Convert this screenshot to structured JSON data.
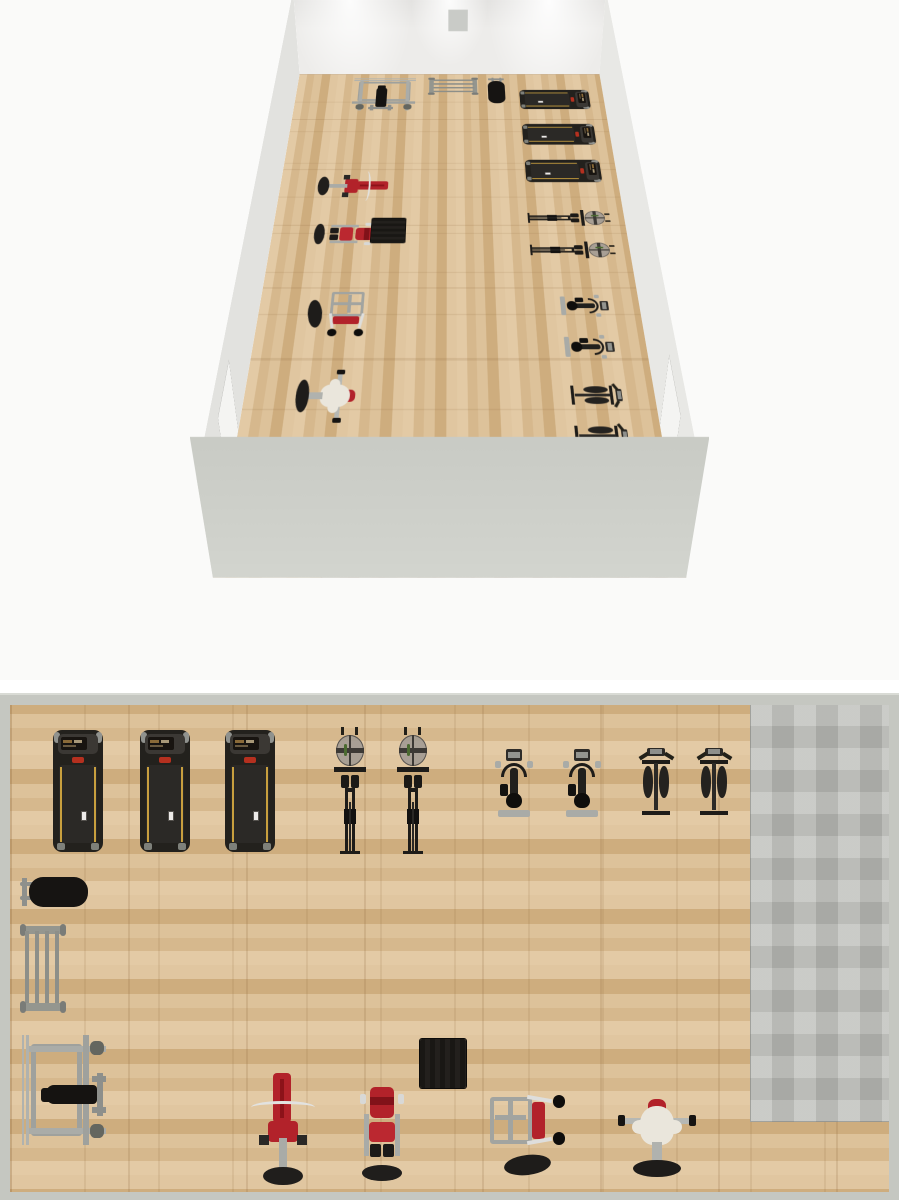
{
  "scene": {
    "views": [
      {
        "id": "perspective-3d",
        "description": "3D overview of gym room"
      },
      {
        "id": "floor-plan-2d",
        "description": "Top-down 2D floor plan of gym room"
      }
    ]
  },
  "palette": {
    "background": "#fafaf9",
    "wood_floor": "#d8bc94",
    "tile_floor": "#bcbdb9",
    "wall_interior": "#edecea",
    "wall_exterior": "#c9cbc5",
    "plan_wall_border": "#c5c7c1",
    "machine_red": "#b2222a",
    "machine_dark": "#1e1c19",
    "metal_gray": "#9fa19d",
    "belt_yellow": "#c89f3e",
    "cream": "#eae6dc",
    "base_black": "#201e1c"
  },
  "room": {
    "inner_width": 879,
    "inner_depth": 540,
    "wall_thickness": 10,
    "tile_area": {
      "x": 740,
      "y": 0,
      "w": 139,
      "h": 417,
      "color": "#bcbdb9"
    },
    "doors": [
      {
        "wall": "right",
        "x": 690,
        "w": 80
      },
      {
        "wall": "left",
        "x": 697,
        "w": 76
      }
    ]
  },
  "equipment": [
    {
      "id": "treadmill-1",
      "type": "treadmill",
      "label": "Treadmill",
      "x": 43,
      "y": 25,
      "w": 50,
      "h": 122
    },
    {
      "id": "treadmill-2",
      "type": "treadmill",
      "label": "Treadmill",
      "x": 130,
      "y": 25,
      "w": 50,
      "h": 122
    },
    {
      "id": "treadmill-3",
      "type": "treadmill",
      "label": "Treadmill",
      "x": 215,
      "y": 25,
      "w": 50,
      "h": 122
    },
    {
      "id": "rower-1",
      "type": "rower",
      "label": "Rowing machine",
      "x": 324,
      "y": 22,
      "w": 32,
      "h": 130
    },
    {
      "id": "rower-2",
      "type": "rower",
      "label": "Rowing machine",
      "x": 387,
      "y": 22,
      "w": 32,
      "h": 130
    },
    {
      "id": "bike-1",
      "type": "bike",
      "label": "Upright exercise bike",
      "x": 485,
      "y": 43,
      "w": 38,
      "h": 70
    },
    {
      "id": "bike-2",
      "type": "bike",
      "label": "Upright exercise bike",
      "x": 553,
      "y": 43,
      "w": 38,
      "h": 70
    },
    {
      "id": "elliptical-1",
      "type": "elliptical",
      "label": "Elliptical cross trainer",
      "x": 627,
      "y": 43,
      "w": 38,
      "h": 74
    },
    {
      "id": "elliptical-2",
      "type": "elliptical",
      "label": "Elliptical cross trainer",
      "x": 685,
      "y": 43,
      "w": 38,
      "h": 74
    },
    {
      "id": "flat-bench",
      "type": "flatbench",
      "label": "Flat bench",
      "x": 10,
      "y": 169,
      "w": 68,
      "h": 36
    },
    {
      "id": "barbell-rack",
      "type": "barbellrack",
      "label": "Barbell storage rack",
      "x": 10,
      "y": 219,
      "w": 46,
      "h": 90
    },
    {
      "id": "power-rack",
      "type": "powerrack",
      "label": "Power rack with bench",
      "x": 10,
      "y": 325,
      "w": 88,
      "h": 120
    },
    {
      "id": "preacher-curl",
      "type": "preacher",
      "label": "Preacher curl bench",
      "x": 238,
      "y": 367,
      "w": 70,
      "h": 114
    },
    {
      "id": "leg-extension",
      "type": "legext",
      "label": "Leg extension machine",
      "x": 350,
      "y": 380,
      "w": 44,
      "h": 98
    },
    {
      "id": "mat-stack",
      "type": "mat",
      "label": "Mat / plyo box stack",
      "x": 410,
      "y": 334,
      "w": 46,
      "h": 49
    },
    {
      "id": "shoulder-press",
      "type": "shoulderpress",
      "label": "Shoulder press machine",
      "x": 478,
      "y": 390,
      "w": 78,
      "h": 84
    },
    {
      "id": "pec-deck",
      "type": "pecdeck",
      "label": "Pec deck machine",
      "x": 608,
      "y": 394,
      "w": 78,
      "h": 80
    }
  ],
  "equipment_counts": {
    "treadmill": 3,
    "rowing_machine": 2,
    "upright_bike": 2,
    "elliptical": 2,
    "flat_bench": 1,
    "barbell_rack": 1,
    "power_rack": 1,
    "preacher_curl": 1,
    "leg_extension": 1,
    "mat_stack": 1,
    "shoulder_press": 1,
    "pec_deck": 1
  }
}
